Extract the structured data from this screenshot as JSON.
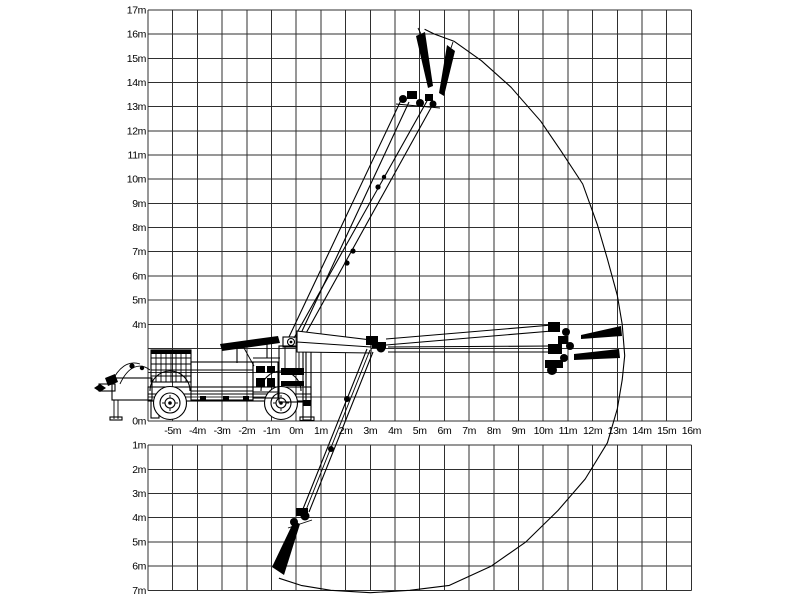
{
  "diagram": {
    "title": "boom-working-range-diagram",
    "unit": "m",
    "axis": {
      "x_labels": [
        "-5m",
        "-4m",
        "-3m",
        "-2m",
        "-1m",
        "0m",
        "1m",
        "2m",
        "3m",
        "4m",
        "5m",
        "6m",
        "7m",
        "8m",
        "9m",
        "10m",
        "11m",
        "12m",
        "13m",
        "14m",
        "15m",
        "16m"
      ],
      "y_above_labels": [
        "17m",
        "16m",
        "15m",
        "14m",
        "13m",
        "12m",
        "11m",
        "10m",
        "9m",
        "8m",
        "7m",
        "6m",
        "5m",
        "4m"
      ],
      "origin_label": "0m",
      "y_below_labels": [
        "1m",
        "2m",
        "3m",
        "4m",
        "5m",
        "6m",
        "7m"
      ]
    },
    "envelope_points_m": [
      [
        -0.7,
        -6.5
      ],
      [
        0.2,
        -6.8
      ],
      [
        1.4,
        -7.0
      ],
      [
        3.0,
        -7.1
      ],
      [
        4.6,
        -7.0
      ],
      [
        6.2,
        -6.8
      ],
      [
        7.9,
        -6.0
      ],
      [
        9.3,
        -5.0
      ],
      [
        10.6,
        -3.7
      ],
      [
        11.7,
        -2.4
      ],
      [
        12.6,
        -0.9
      ],
      [
        13.0,
        0.5
      ],
      [
        13.2,
        1.7
      ],
      [
        13.3,
        2.7
      ],
      [
        13.2,
        4.0
      ],
      [
        13.0,
        5.2
      ],
      [
        12.6,
        6.7
      ],
      [
        12.2,
        8.1
      ],
      [
        11.6,
        9.8
      ],
      [
        10.7,
        11.2
      ],
      [
        9.9,
        12.4
      ],
      [
        8.7,
        13.8
      ],
      [
        7.5,
        14.9
      ],
      [
        6.4,
        15.7
      ],
      [
        5.6,
        16.0
      ],
      [
        5.2,
        16.2
      ]
    ],
    "colors": {
      "background": "#ffffff",
      "grid": "#2f2f2f",
      "drawing": "#000000"
    }
  }
}
